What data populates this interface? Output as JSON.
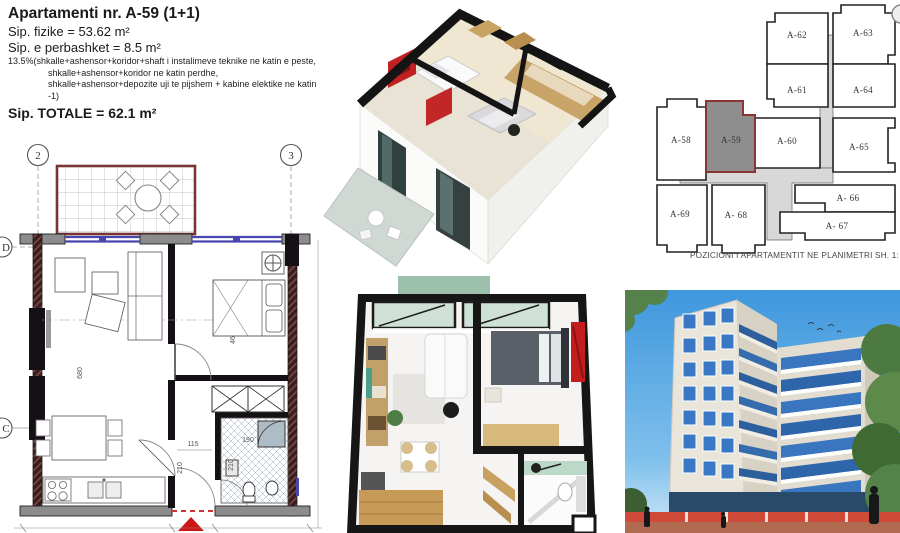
{
  "info": {
    "title": "Apartamenti nr. A-59 (1+1)",
    "area_physical": "Sip. fizike = 53.62 m²",
    "area_shared": "Sip. e perbashket = 8.5 m²",
    "note_line1": "13.5%(shkalle+ashensor+koridor+shaft i instalimeve teknike ne katin e peste,",
    "note_line2": "shkalle+ashensor+koridor ne katin perdhe,",
    "note_line3": "shkalle+ashensor+depozite uji te pijshem + kabine elektike ne katin -1)",
    "area_total": "Sip. TOTALE =  62.1 m²"
  },
  "key_plan": {
    "caption": "POZICIONI I APARTAMENTIT NE PLANIMETRI  SH. 1:",
    "units": {
      "a58": "A-58",
      "a59": "A-59",
      "a60": "A-60",
      "a61": "A-61",
      "a62": "A-62",
      "a63": "A-63",
      "a64": "A-64",
      "a65": "A-65",
      "a66": "A- 66",
      "a67": "A- 67",
      "a68": "A- 68",
      "a69": "A-69"
    }
  },
  "floor_plan": {
    "grid": {
      "col2": "2",
      "col3": "3",
      "rowD": "D",
      "rowC": "C"
    },
    "dims": {
      "living_w": "315",
      "living_h": "680",
      "bed_w": "315",
      "bed_h": "460",
      "hall_w": "115",
      "hall_h": "210",
      "bath_w": "190",
      "bath_h": "210"
    }
  },
  "colors": {
    "unit_highlight_fill": "#8e8e8e",
    "unit_highlight_border": "#8b3434",
    "corridor_fill": "#d8d8d8",
    "window_blue": "#4646ae",
    "entry_red": "#cc1515",
    "balcony_border": "#7a3434",
    "sky_blue": "#58a7e0",
    "facade_beige": "#e9e5da",
    "glass_blue": "#3a77c4",
    "tree_green": "#55824a",
    "barrier_red": "#cf4a38",
    "wood": "#c9a468",
    "accent_art_red": "#c41d1d",
    "sage_green": "#9cc0ab"
  }
}
